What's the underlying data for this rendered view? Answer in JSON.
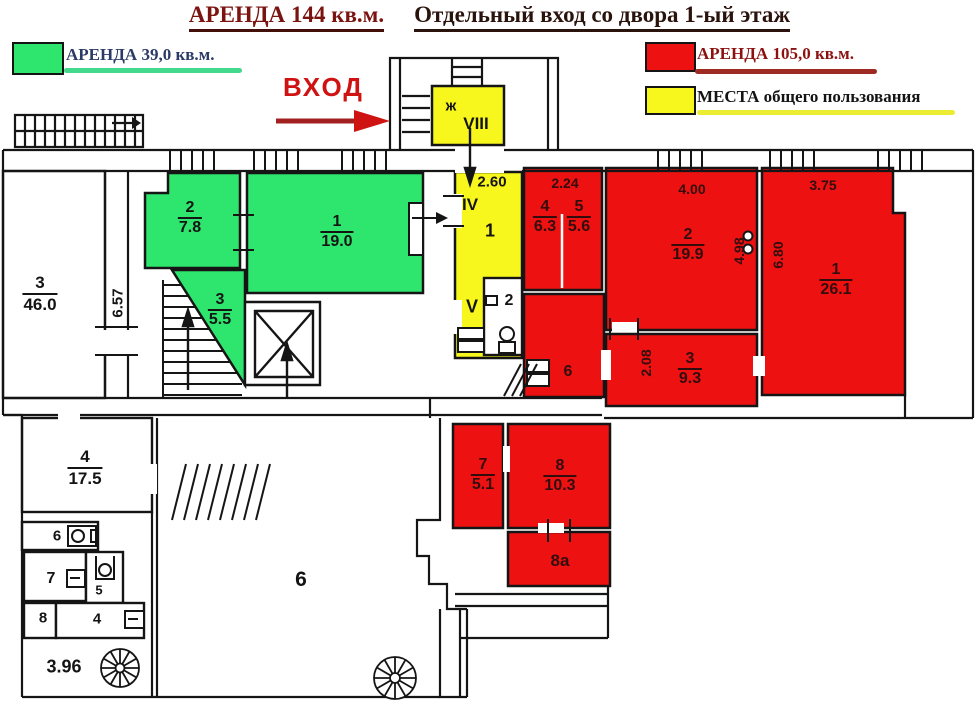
{
  "title": {
    "part1": "АРЕНДА 144 кв.м.",
    "part2": "Отдельный вход со двора 1-ый этаж"
  },
  "legend": {
    "green_label": "АРЕНДА 39,0 кв.м.",
    "red_label": "АРЕНДА 105,0 кв.м.",
    "yellow_label": "МЕСТА общего пользования"
  },
  "entrance_label": "ВХОД",
  "colors": {
    "green_zone": "#2ee56e",
    "red_zone": "#ee1111",
    "yellow_zone": "#f7f71e",
    "title_red": "#7a1410",
    "entrance_red": "#cf1313",
    "wall": "#151515"
  },
  "rooms": {
    "green_2": {
      "num": "2",
      "area": "7.8"
    },
    "green_1": {
      "num": "1",
      "area": "19.0"
    },
    "green_3": {
      "num": "3",
      "area": "5.5"
    },
    "white_3": {
      "num": "3",
      "area": "46.0"
    },
    "white_4": {
      "num": "4",
      "area": "17.5"
    },
    "red_4": {
      "num": "4",
      "area": "6.3"
    },
    "red_5": {
      "num": "5",
      "area": "5.6"
    },
    "red_2": {
      "num": "2",
      "area": "19.9"
    },
    "red_1": {
      "num": "1",
      "area": "26.1"
    },
    "red_3": {
      "num": "3",
      "area": "9.3"
    },
    "red_7": {
      "num": "7",
      "area": "5.1"
    },
    "red_8": {
      "num": "8",
      "area": "10.3"
    },
    "red_8a": {
      "num": "8а"
    },
    "red_6": {
      "num": "6"
    },
    "small_6": {
      "num": "6"
    },
    "small_7": {
      "num": "7"
    },
    "small_5": {
      "num": "5"
    },
    "small_8": {
      "num": "8"
    },
    "small_4": {
      "num": "4"
    },
    "big_6": {
      "num": "6"
    }
  },
  "corridor": {
    "room_zh": "ж",
    "room_viii": "VIII",
    "label_iv": "IV",
    "corridor_1": "1",
    "label_v": "V",
    "wc_2": "2"
  },
  "dimensions": {
    "left_wall": "6.57",
    "corridor_width": "2.60",
    "rooms45_width": "2.24",
    "room2_width": "4.00",
    "room1_width": "3.75",
    "room1_height": "6.80",
    "room2_height": "4.98",
    "room3_height": "2.08",
    "bottom_left": "3.96"
  }
}
